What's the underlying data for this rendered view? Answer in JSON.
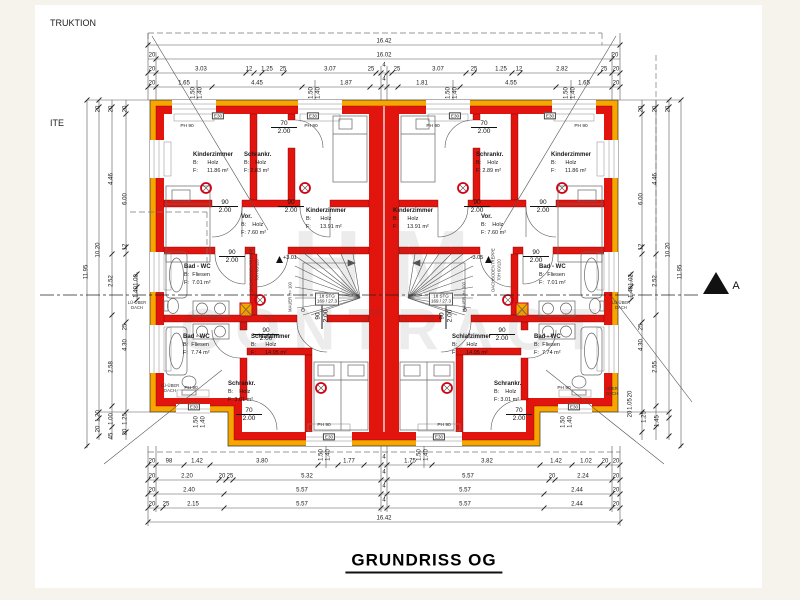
{
  "title": "GRUNDRISS OG",
  "edge_texts": {
    "top_left_1": "TRUKTION",
    "top_left_2": "ITE",
    "section_marker": "A"
  },
  "watermark": {
    "line1": "HM",
    "line2": "CONTRACT"
  },
  "colors": {
    "wall_red": "#e2150e",
    "insulation_orange": "#f7a600",
    "line": "#444444"
  },
  "stairs": {
    "steps": "18 STG",
    "ratio": "169 / 27.3",
    "left_level": "+3.01",
    "right_level": "-3.05"
  },
  "rooms": [
    {
      "name": "Kinderzimmer",
      "l1": "B:      Holz",
      "l2": "F:      11.86 m²",
      "x": 193,
      "y": 152
    },
    {
      "name": "Schrankr.",
      "l1": "B:    Holz",
      "l2": "F: 2.83 m²",
      "x": 244,
      "y": 152
    },
    {
      "name": "Kinderzimmer",
      "l1": "B:      Holz",
      "l2": "F:      13.91 m²",
      "x": 306,
      "y": 208
    },
    {
      "name": "Vor.",
      "l1": "B:    Holz",
      "l2": "F: 7.60 m²",
      "x": 241,
      "y": 214
    },
    {
      "name": "Bad - WC",
      "l1": "B:  Fliesen",
      "l2": "F:  7.01 m²",
      "x": 184,
      "y": 264
    },
    {
      "name": "Bad - WC",
      "l1": "B:  Fliesen",
      "l2": "F:  7.74 m²",
      "x": 183,
      "y": 334
    },
    {
      "name": "Schrankr.",
      "l1": "B:    Holz",
      "l2": "F: 3.01 m²",
      "x": 228,
      "y": 381
    },
    {
      "name": "Schlafzimmer",
      "l1": "B:      Holz",
      "l2": "F:      14.95 m²",
      "x": 251,
      "y": 334
    },
    {
      "name": "Kinderzimmer",
      "l1": "B:      Holz",
      "l2": "F:      13.91 m²",
      "x": 393,
      "y": 208
    },
    {
      "name": "Schrankr.",
      "l1": "B:    Holz",
      "l2": "F: 2.89 m²",
      "x": 476,
      "y": 152
    },
    {
      "name": "Kinderzimmer",
      "l1": "B:      Holz",
      "l2": "F:      11.86 m²",
      "x": 551,
      "y": 152
    },
    {
      "name": "Vor.",
      "l1": "B:    Holz",
      "l2": "F: 7.60 m²",
      "x": 481,
      "y": 214
    },
    {
      "name": "Bad - WC",
      "l1": "B:  Fliesen",
      "l2": "F:  7.01 m²",
      "x": 539,
      "y": 264
    },
    {
      "name": "Bad - WC",
      "l1": "B:  Fliesen",
      "l2": "F:  7.74 m²",
      "x": 534,
      "y": 334
    },
    {
      "name": "Schrankr.",
      "l1": "B:    Holz",
      "l2": "F: 3.01 m²",
      "x": 494,
      "y": 381
    },
    {
      "name": "Schlafzimmer",
      "l1": "B:      Holz",
      "l2": "F:      14.95 m²",
      "x": 452,
      "y": 334
    }
  ],
  "doors": [
    {
      "w": "90",
      "h": "2.00",
      "x": 225,
      "y": 199
    },
    {
      "w": "90",
      "h": "2.00",
      "x": 291,
      "y": 199
    },
    {
      "w": "70",
      "h": "2.00",
      "x": 284,
      "y": 120
    },
    {
      "w": "90",
      "h": "2.00",
      "x": 232,
      "y": 249
    },
    {
      "w": "90",
      "h": "2.00",
      "x": 266,
      "y": 327
    },
    {
      "w": "70",
      "h": "2.00",
      "x": 249,
      "y": 407
    },
    {
      "w": "90",
      "h": "2.00",
      "x": 322,
      "y": 316,
      "r": 1
    },
    {
      "w": "90",
      "h": "2.00",
      "x": 543,
      "y": 199
    },
    {
      "w": "90",
      "h": "2.00",
      "x": 477,
      "y": 199
    },
    {
      "w": "70",
      "h": "2.00",
      "x": 484,
      "y": 120
    },
    {
      "w": "90",
      "h": "2.00",
      "x": 536,
      "y": 249
    },
    {
      "w": "90",
      "h": "2.00",
      "x": 502,
      "y": 327
    },
    {
      "w": "70",
      "h": "2.00",
      "x": 519,
      "y": 407
    },
    {
      "w": "90",
      "h": "2.00",
      "x": 446,
      "y": 316,
      "r": 1
    }
  ],
  "tags": [
    {
      "t": "E30",
      "x": 218,
      "y": 116,
      "b": 1
    },
    {
      "t": "E30",
      "x": 313,
      "y": 116,
      "b": 1
    },
    {
      "t": "E30",
      "x": 455,
      "y": 116,
      "b": 1
    },
    {
      "t": "E30",
      "x": 550,
      "y": 116,
      "b": 1
    },
    {
      "t": "E30",
      "x": 194,
      "y": 407,
      "b": 1
    },
    {
      "t": "E30",
      "x": 574,
      "y": 407,
      "b": 1
    },
    {
      "t": "E30",
      "x": 329,
      "y": 437,
      "b": 1
    },
    {
      "t": "E30",
      "x": 439,
      "y": 437,
      "b": 1
    },
    {
      "t": "PH 90",
      "x": 187,
      "y": 127
    },
    {
      "t": "PH 90",
      "x": 311,
      "y": 127
    },
    {
      "t": "PH 90",
      "x": 433,
      "y": 127
    },
    {
      "t": "PH 90",
      "x": 581,
      "y": 127
    },
    {
      "t": "PH 90",
      "x": 191,
      "y": 389
    },
    {
      "t": "PH 90",
      "x": 564,
      "y": 389
    },
    {
      "t": "PH 90",
      "x": 324,
      "y": 426
    },
    {
      "t": "PH 90",
      "x": 444,
      "y": 426
    }
  ],
  "lue_notes": [
    {
      "t": "LÜ-ÜBER\nDACH",
      "x": 137,
      "y": 306
    },
    {
      "t": "LÜ-ÜBER\nDACH",
      "x": 170,
      "y": 389
    },
    {
      "t": "LÜ-ÜBER\nDACH",
      "x": 621,
      "y": 306
    },
    {
      "t": "ÜBER\nDACH",
      "x": 612,
      "y": 392
    }
  ],
  "vtexts": [
    {
      "t": "DACHBODENTREPPE",
      "x": 252,
      "y": 270
    },
    {
      "t": "70H 60/120",
      "x": 258,
      "y": 270
    },
    {
      "t": "MAUER H= 100",
      "x": 291,
      "y": 297
    },
    {
      "t": "DACHBODENTREPPE",
      "x": 494,
      "y": 270
    },
    {
      "t": "70H 60/120",
      "x": 500,
      "y": 270
    },
    {
      "t": "MAUER H= 100",
      "x": 465,
      "y": 297
    }
  ],
  "dimension_labels": [
    {
      "t": "16.42",
      "x": 384,
      "y": 42
    },
    {
      "t": "20",
      "x": 152,
      "y": 56
    },
    {
      "t": "16.02",
      "x": 384,
      "y": 56
    },
    {
      "t": "20",
      "x": 615,
      "y": 56
    },
    {
      "t": "20",
      "x": 152,
      "y": 70
    },
    {
      "t": "3.03",
      "x": 201,
      "y": 70
    },
    {
      "t": "12",
      "x": 249,
      "y": 70
    },
    {
      "t": "1.25",
      "x": 267,
      "y": 70
    },
    {
      "t": "25",
      "x": 283,
      "y": 70
    },
    {
      "t": "3.07",
      "x": 330,
      "y": 70
    },
    {
      "t": "25",
      "x": 371,
      "y": 70
    },
    {
      "t": "4",
      "x": 384,
      "y": 66
    },
    {
      "t": "25",
      "x": 397,
      "y": 70
    },
    {
      "t": "3.07",
      "x": 438,
      "y": 70
    },
    {
      "t": "25",
      "x": 474,
      "y": 70
    },
    {
      "t": "1.25",
      "x": 501,
      "y": 70
    },
    {
      "t": "12",
      "x": 519,
      "y": 70
    },
    {
      "t": "2.82",
      "x": 562,
      "y": 70
    },
    {
      "t": "25",
      "x": 604,
      "y": 70
    },
    {
      "t": "20",
      "x": 616,
      "y": 70
    },
    {
      "t": "20",
      "x": 152,
      "y": 84
    },
    {
      "t": "1.65",
      "x": 184,
      "y": 84
    },
    {
      "t": "4.45",
      "x": 257,
      "y": 84
    },
    {
      "t": "1.87",
      "x": 346,
      "y": 84
    },
    {
      "t": "4",
      "x": 384,
      "y": 80
    },
    {
      "t": "1.81",
      "x": 422,
      "y": 84
    },
    {
      "t": "4.55",
      "x": 511,
      "y": 84
    },
    {
      "t": "1.65",
      "x": 584,
      "y": 84
    },
    {
      "t": "20",
      "x": 616,
      "y": 84
    },
    {
      "t": "1.50",
      "x": 194,
      "y": 93,
      "r": 1
    },
    {
      "t": "1.40",
      "x": 201,
      "y": 93,
      "r": 1
    },
    {
      "t": "1.50",
      "x": 312,
      "y": 93,
      "r": 1
    },
    {
      "t": "1.40",
      "x": 319,
      "y": 93,
      "r": 1
    },
    {
      "t": "1.50",
      "x": 449,
      "y": 93,
      "r": 1
    },
    {
      "t": "1.40",
      "x": 456,
      "y": 93,
      "r": 1
    },
    {
      "t": "1.50",
      "x": 567,
      "y": 93,
      "r": 1
    },
    {
      "t": "1.40",
      "x": 574,
      "y": 93,
      "r": 1
    },
    {
      "t": "20",
      "x": 152,
      "y": 462
    },
    {
      "t": "98",
      "x": 169,
      "y": 462
    },
    {
      "t": "1.42",
      "x": 197,
      "y": 462
    },
    {
      "t": "3.80",
      "x": 262,
      "y": 462
    },
    {
      "t": "1.77",
      "x": 349,
      "y": 462
    },
    {
      "t": "4",
      "x": 384,
      "y": 458
    },
    {
      "t": "1.75",
      "x": 410,
      "y": 462
    },
    {
      "t": "3.82",
      "x": 487,
      "y": 462
    },
    {
      "t": "1.42",
      "x": 556,
      "y": 462
    },
    {
      "t": "1.02",
      "x": 586,
      "y": 462
    },
    {
      "t": "20",
      "x": 605,
      "y": 462
    },
    {
      "t": "20",
      "x": 616,
      "y": 462
    },
    {
      "t": "1.50",
      "x": 322,
      "y": 455,
      "r": 1
    },
    {
      "t": "1.40",
      "x": 329,
      "y": 455,
      "r": 1
    },
    {
      "t": "1.50",
      "x": 420,
      "y": 455,
      "r": 1
    },
    {
      "t": "1.40",
      "x": 427,
      "y": 455,
      "r": 1
    },
    {
      "t": "20",
      "x": 152,
      "y": 477
    },
    {
      "t": "2.20",
      "x": 187,
      "y": 477
    },
    {
      "t": "20",
      "x": 222,
      "y": 477
    },
    {
      "t": "25",
      "x": 230,
      "y": 477
    },
    {
      "t": "5.32",
      "x": 307,
      "y": 477
    },
    {
      "t": "4",
      "x": 384,
      "y": 473
    },
    {
      "t": "5.57",
      "x": 468,
      "y": 477
    },
    {
      "t": "20",
      "x": 552,
      "y": 477
    },
    {
      "t": "2.24",
      "x": 583,
      "y": 477
    },
    {
      "t": "20",
      "x": 616,
      "y": 477
    },
    {
      "t": "20",
      "x": 152,
      "y": 491
    },
    {
      "t": "2.40",
      "x": 189,
      "y": 491
    },
    {
      "t": "5.57",
      "x": 302,
      "y": 491
    },
    {
      "t": "4",
      "x": 384,
      "y": 487
    },
    {
      "t": "5.57",
      "x": 465,
      "y": 491
    },
    {
      "t": "2.44",
      "x": 577,
      "y": 491
    },
    {
      "t": "20",
      "x": 616,
      "y": 491
    },
    {
      "t": "20",
      "x": 152,
      "y": 505
    },
    {
      "t": "25",
      "x": 166,
      "y": 505
    },
    {
      "t": "2.15",
      "x": 193,
      "y": 505
    },
    {
      "t": "5.57",
      "x": 302,
      "y": 505
    },
    {
      "t": "4",
      "x": 384,
      "y": 501
    },
    {
      "t": "5.57",
      "x": 465,
      "y": 505
    },
    {
      "t": "2.44",
      "x": 577,
      "y": 505
    },
    {
      "t": "20",
      "x": 616,
      "y": 505
    },
    {
      "t": "16.42",
      "x": 384,
      "y": 519
    },
    {
      "t": "11.95",
      "x": 87,
      "y": 272,
      "r": 1
    },
    {
      "t": "20",
      "x": 99,
      "y": 109,
      "r": 1
    },
    {
      "t": "10.20",
      "x": 99,
      "y": 250,
      "r": 1
    },
    {
      "t": "1.20",
      "x": 99,
      "y": 416,
      "r": 1
    },
    {
      "t": "20",
      "x": 99,
      "y": 429,
      "r": 1
    },
    {
      "t": "20",
      "x": 112,
      "y": 109,
      "r": 1
    },
    {
      "t": "4.46",
      "x": 112,
      "y": 179,
      "r": 1
    },
    {
      "t": "2.52",
      "x": 112,
      "y": 281,
      "r": 1
    },
    {
      "t": "2.58",
      "x": 112,
      "y": 367,
      "r": 1
    },
    {
      "t": "1.00",
      "x": 112,
      "y": 419,
      "r": 1
    },
    {
      "t": "45",
      "x": 112,
      "y": 436,
      "r": 1
    },
    {
      "t": "20",
      "x": 126,
      "y": 109,
      "r": 1
    },
    {
      "t": "6.00",
      "x": 126,
      "y": 199,
      "r": 1
    },
    {
      "t": "12",
      "x": 126,
      "y": 247,
      "r": 1
    },
    {
      "t": "25",
      "x": 126,
      "y": 327,
      "r": 1
    },
    {
      "t": "4.30",
      "x": 126,
      "y": 345,
      "r": 1
    },
    {
      "t": "1.25",
      "x": 126,
      "y": 419,
      "r": 1
    },
    {
      "t": "20",
      "x": 126,
      "y": 432,
      "r": 1
    },
    {
      "t": "1.00",
      "x": 137,
      "y": 280,
      "r": 1
    },
    {
      "t": "1.40",
      "x": 137,
      "y": 292,
      "r": 1
    },
    {
      "t": "1.50",
      "x": 197,
      "y": 422,
      "r": 1
    },
    {
      "t": "1.40",
      "x": 204,
      "y": 422,
      "r": 1
    },
    {
      "t": "11.95",
      "x": 681,
      "y": 272,
      "r": 1
    },
    {
      "t": "20",
      "x": 669,
      "y": 109,
      "r": 1
    },
    {
      "t": "10.20",
      "x": 669,
      "y": 250,
      "r": 1
    },
    {
      "t": "1.45",
      "x": 658,
      "y": 421,
      "r": 1
    },
    {
      "t": "20",
      "x": 656,
      "y": 109,
      "r": 1
    },
    {
      "t": "4.46",
      "x": 656,
      "y": 179,
      "r": 1
    },
    {
      "t": "2.52",
      "x": 656,
      "y": 281,
      "r": 1
    },
    {
      "t": "2.55",
      "x": 656,
      "y": 367,
      "r": 1
    },
    {
      "t": "1.25",
      "x": 645,
      "y": 417,
      "r": 1
    },
    {
      "t": "20",
      "x": 642,
      "y": 109,
      "r": 1
    },
    {
      "t": "6.00",
      "x": 642,
      "y": 199,
      "r": 1
    },
    {
      "t": "12",
      "x": 642,
      "y": 247,
      "r": 1
    },
    {
      "t": "25",
      "x": 642,
      "y": 327,
      "r": 1
    },
    {
      "t": "4.30",
      "x": 642,
      "y": 345,
      "r": 1
    },
    {
      "t": "20",
      "x": 631,
      "y": 394,
      "r": 1
    },
    {
      "t": "1.05",
      "x": 631,
      "y": 404,
      "r": 1
    },
    {
      "t": "20",
      "x": 631,
      "y": 414,
      "r": 1
    },
    {
      "t": "1.02",
      "x": 632,
      "y": 280,
      "r": 1
    },
    {
      "t": "1.40",
      "x": 632,
      "y": 292,
      "r": 1
    },
    {
      "t": "1.50",
      "x": 564,
      "y": 422,
      "r": 1
    },
    {
      "t": "1.40",
      "x": 571,
      "y": 422,
      "r": 1
    }
  ]
}
